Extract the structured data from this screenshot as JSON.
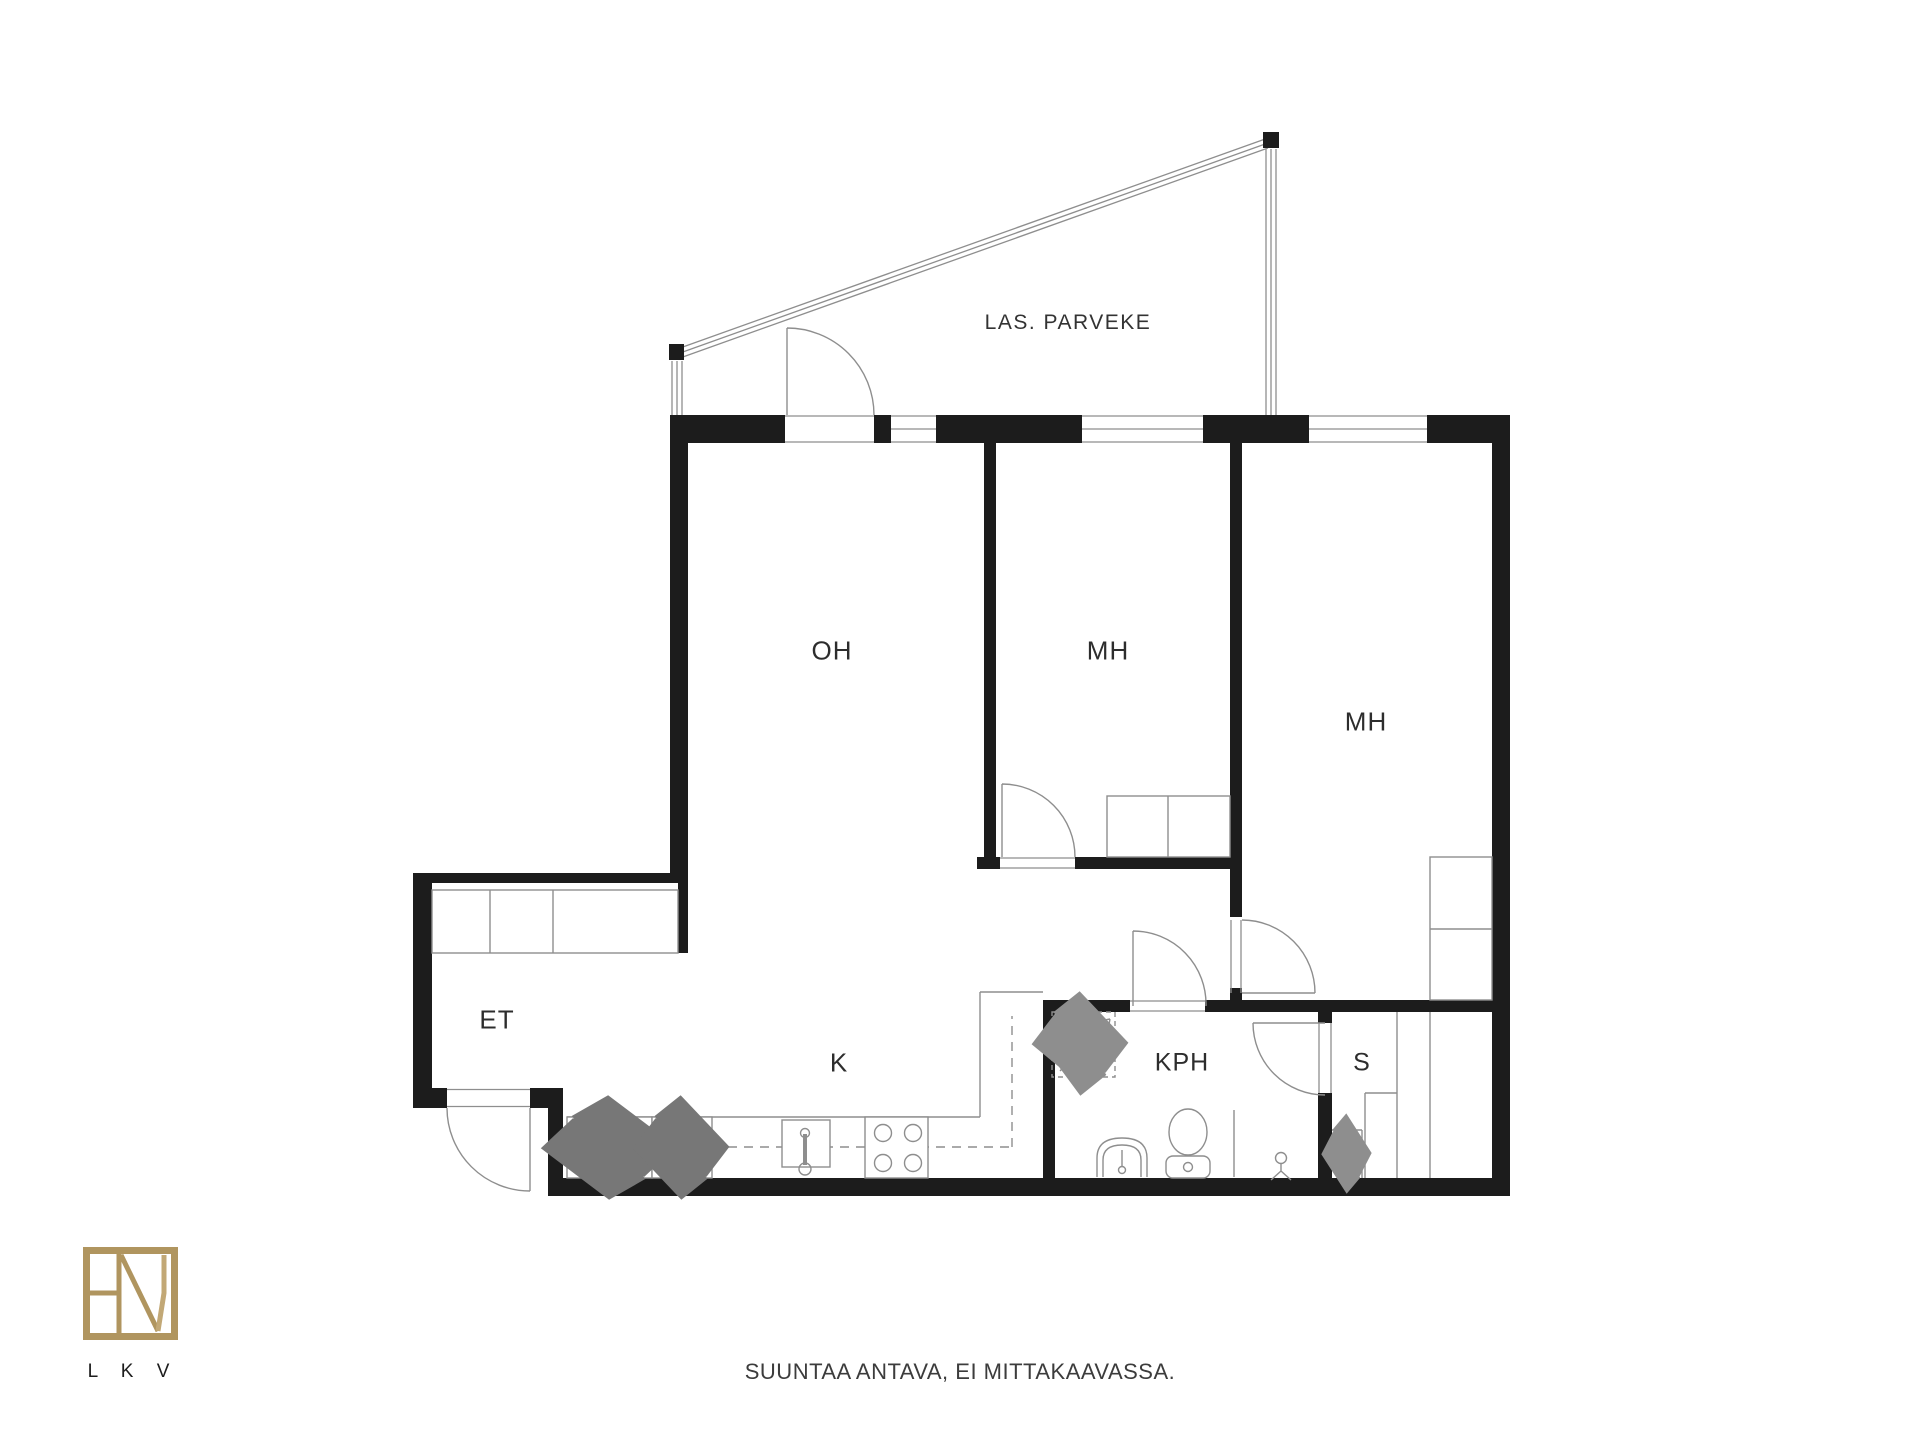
{
  "plan": {
    "labels": {
      "balcony": "LAS. PARVEKE",
      "living_room": "OH",
      "bedroom1": "MH",
      "bedroom2": "MH",
      "entry": "ET",
      "kitchen": "K",
      "bathroom": "KPH",
      "sauna": "S"
    },
    "colors": {
      "wall": "#1c1c1c",
      "thin_line": "#8e8e8e",
      "text": "#2d2d2d",
      "logo_gold": "#b0955f"
    }
  },
  "footer": {
    "logo_text": "L K V",
    "disclaimer": "SUUNTAA ANTAVA, EI MITTAKAAVASSA."
  }
}
